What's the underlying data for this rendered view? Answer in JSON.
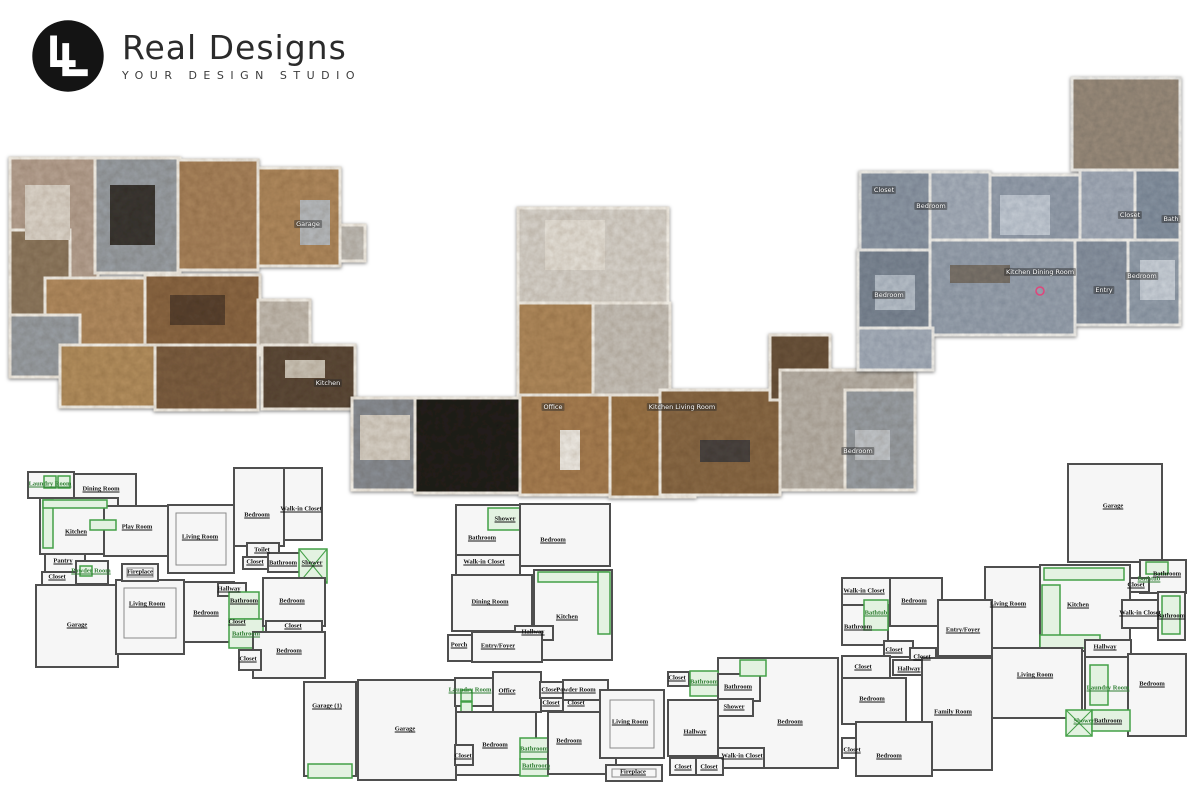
{
  "logo": {
    "brand": "Real Designs",
    "tagline": "YOUR DESIGN STUDIO",
    "monogram": "LL"
  },
  "colors": {
    "accent_green": "#43a047",
    "wall_gray": "#4f4f4f",
    "scan_warm": "#a97f54",
    "scan_cool": "#97a0ac",
    "marker_pink": "#e0457b"
  },
  "plans": {
    "scan_left": {
      "name": "3D scan floor plan (left)",
      "labels": [
        {
          "text": "Garage",
          "x": 308,
          "y": 224
        },
        {
          "text": "Kitchen",
          "x": 328,
          "y": 383
        }
      ]
    },
    "scan_center": {
      "name": "3D scan floor plan (center)",
      "labels": [
        {
          "text": "Office",
          "x": 553,
          "y": 407
        },
        {
          "text": "Kitchen Living Room",
          "x": 682,
          "y": 407
        },
        {
          "text": "Bedroom",
          "x": 858,
          "y": 451
        }
      ]
    },
    "scan_right": {
      "name": "3D scan floor plan (right)",
      "labels": [
        {
          "text": "Closet",
          "x": 884,
          "y": 190
        },
        {
          "text": "Bedroom",
          "x": 931,
          "y": 206
        },
        {
          "text": "Closet",
          "x": 1130,
          "y": 215
        },
        {
          "text": "Bath",
          "x": 1171,
          "y": 219
        },
        {
          "text": "Kitchen Dining Room",
          "x": 1040,
          "y": 272
        },
        {
          "text": "Entry",
          "x": 1104,
          "y": 290
        },
        {
          "text": "Bedroom",
          "x": 1142,
          "y": 276
        },
        {
          "text": "Bedroom",
          "x": 889,
          "y": 295
        }
      ]
    },
    "schematic_left": {
      "name": "2D schematic floor plan (bottom left)",
      "labels": [
        {
          "text": "Laundry Room",
          "x": 50,
          "y": 484,
          "green": true
        },
        {
          "text": "Dining Room",
          "x": 101,
          "y": 489
        },
        {
          "text": "Kitchen",
          "x": 76,
          "y": 532
        },
        {
          "text": "Play Room",
          "x": 137,
          "y": 527
        },
        {
          "text": "Living Room",
          "x": 200,
          "y": 537
        },
        {
          "text": "Bedroom",
          "x": 257,
          "y": 515
        },
        {
          "text": "Walk-in Closet",
          "x": 301,
          "y": 509
        },
        {
          "text": "Toilet",
          "x": 262,
          "y": 550
        },
        {
          "text": "Closet",
          "x": 255,
          "y": 562
        },
        {
          "text": "Bathroom",
          "x": 283,
          "y": 563
        },
        {
          "text": "Shower",
          "x": 312,
          "y": 563
        },
        {
          "text": "Pantry",
          "x": 63,
          "y": 561
        },
        {
          "text": "Powder Room",
          "x": 91,
          "y": 571,
          "green": true
        },
        {
          "text": "Closet",
          "x": 57,
          "y": 577
        },
        {
          "text": "Fireplace",
          "x": 140,
          "y": 572
        },
        {
          "text": "Garage",
          "x": 77,
          "y": 625
        },
        {
          "text": "Living Room",
          "x": 147,
          "y": 604
        },
        {
          "text": "Bedroom",
          "x": 206,
          "y": 613
        },
        {
          "text": "Hallway",
          "x": 229,
          "y": 589
        },
        {
          "text": "Bathroom",
          "x": 244,
          "y": 601
        },
        {
          "text": "Closet",
          "x": 237,
          "y": 622
        },
        {
          "text": "Bathroom",
          "x": 246,
          "y": 634,
          "green": true
        },
        {
          "text": "Bedroom",
          "x": 292,
          "y": 601
        },
        {
          "text": "Closet",
          "x": 293,
          "y": 626
        },
        {
          "text": "Bedroom",
          "x": 289,
          "y": 651
        },
        {
          "text": "Closet",
          "x": 248,
          "y": 659
        }
      ]
    },
    "schematic_center": {
      "name": "2D schematic floor plan (bottom center)",
      "labels": [
        {
          "text": "Shower",
          "x": 505,
          "y": 519
        },
        {
          "text": "Bathroom",
          "x": 482,
          "y": 538
        },
        {
          "text": "Bedroom",
          "x": 553,
          "y": 540
        },
        {
          "text": "Walk-in Closet",
          "x": 484,
          "y": 562
        },
        {
          "text": "Dining Room",
          "x": 490,
          "y": 602
        },
        {
          "text": "Kitchen",
          "x": 567,
          "y": 617
        },
        {
          "text": "Hallway",
          "x": 533,
          "y": 632
        },
        {
          "text": "Porch",
          "x": 459,
          "y": 645
        },
        {
          "text": "Entry/Foyer",
          "x": 498,
          "y": 646
        },
        {
          "text": "Garage (1)",
          "x": 327,
          "y": 706
        },
        {
          "text": "Garage",
          "x": 405,
          "y": 729
        },
        {
          "text": "Laundry Room",
          "x": 470,
          "y": 690,
          "green": true
        },
        {
          "text": "Office",
          "x": 507,
          "y": 691
        },
        {
          "text": "Closet",
          "x": 550,
          "y": 690
        },
        {
          "text": "Powder Room",
          "x": 576,
          "y": 690
        },
        {
          "text": "Closet",
          "x": 551,
          "y": 703
        },
        {
          "text": "Closet",
          "x": 576,
          "y": 703
        },
        {
          "text": "Bedroom",
          "x": 495,
          "y": 745
        },
        {
          "text": "Closet",
          "x": 463,
          "y": 756
        },
        {
          "text": "Bathroom",
          "x": 534,
          "y": 749,
          "green": true
        },
        {
          "text": "Bathroom",
          "x": 536,
          "y": 766,
          "green": true
        },
        {
          "text": "Bedroom",
          "x": 569,
          "y": 741
        },
        {
          "text": "Living Room",
          "x": 630,
          "y": 722
        },
        {
          "text": "Fireplace",
          "x": 633,
          "y": 772
        },
        {
          "text": "Closet",
          "x": 677,
          "y": 678
        },
        {
          "text": "Bathroom",
          "x": 704,
          "y": 682,
          "green": true
        },
        {
          "text": "Bathroom",
          "x": 738,
          "y": 687
        },
        {
          "text": "Shower",
          "x": 734,
          "y": 707
        },
        {
          "text": "Hallway",
          "x": 695,
          "y": 732
        },
        {
          "text": "Bedroom",
          "x": 790,
          "y": 722
        },
        {
          "text": "Walk-in Closet",
          "x": 742,
          "y": 756
        },
        {
          "text": "Closet",
          "x": 683,
          "y": 767
        },
        {
          "text": "Closet",
          "x": 709,
          "y": 767
        }
      ]
    },
    "schematic_right": {
      "name": "2D schematic floor plan (bottom right)",
      "labels": [
        {
          "text": "Garage",
          "x": 1113,
          "y": 506
        },
        {
          "text": "Walk-in Closet",
          "x": 864,
          "y": 591
        },
        {
          "text": "Bedroom",
          "x": 914,
          "y": 601
        },
        {
          "text": "Bathtub",
          "x": 876,
          "y": 613,
          "green": true
        },
        {
          "text": "Bathroom",
          "x": 858,
          "y": 627
        },
        {
          "text": "Entry/Foyer",
          "x": 963,
          "y": 630
        },
        {
          "text": "Living Room",
          "x": 1008,
          "y": 604
        },
        {
          "text": "Kitchen",
          "x": 1078,
          "y": 605
        },
        {
          "text": "Bathroom",
          "x": 1167,
          "y": 574
        },
        {
          "text": "Bathtub",
          "x": 1149,
          "y": 579,
          "green": true
        },
        {
          "text": "Closet",
          "x": 1136,
          "y": 585
        },
        {
          "text": "Walk-in Closet",
          "x": 1140,
          "y": 613
        },
        {
          "text": "Bathroom",
          "x": 1171,
          "y": 616
        },
        {
          "text": "Closet",
          "x": 894,
          "y": 650
        },
        {
          "text": "Closet",
          "x": 922,
          "y": 657
        },
        {
          "text": "Closet",
          "x": 863,
          "y": 667
        },
        {
          "text": "Hallway",
          "x": 909,
          "y": 669
        },
        {
          "text": "Bedroom",
          "x": 872,
          "y": 699
        },
        {
          "text": "Family Room",
          "x": 953,
          "y": 712
        },
        {
          "text": "Living Room",
          "x": 1035,
          "y": 675
        },
        {
          "text": "Hallway",
          "x": 1105,
          "y": 647
        },
        {
          "text": "Laundry Room",
          "x": 1108,
          "y": 688,
          "green": true
        },
        {
          "text": "Bedroom",
          "x": 1152,
          "y": 684
        },
        {
          "text": "Shower",
          "x": 1084,
          "y": 721,
          "green": true
        },
        {
          "text": "Bathroom",
          "x": 1108,
          "y": 721
        },
        {
          "text": "Closet",
          "x": 852,
          "y": 750
        },
        {
          "text": "Bedroom",
          "x": 889,
          "y": 756
        }
      ]
    }
  }
}
